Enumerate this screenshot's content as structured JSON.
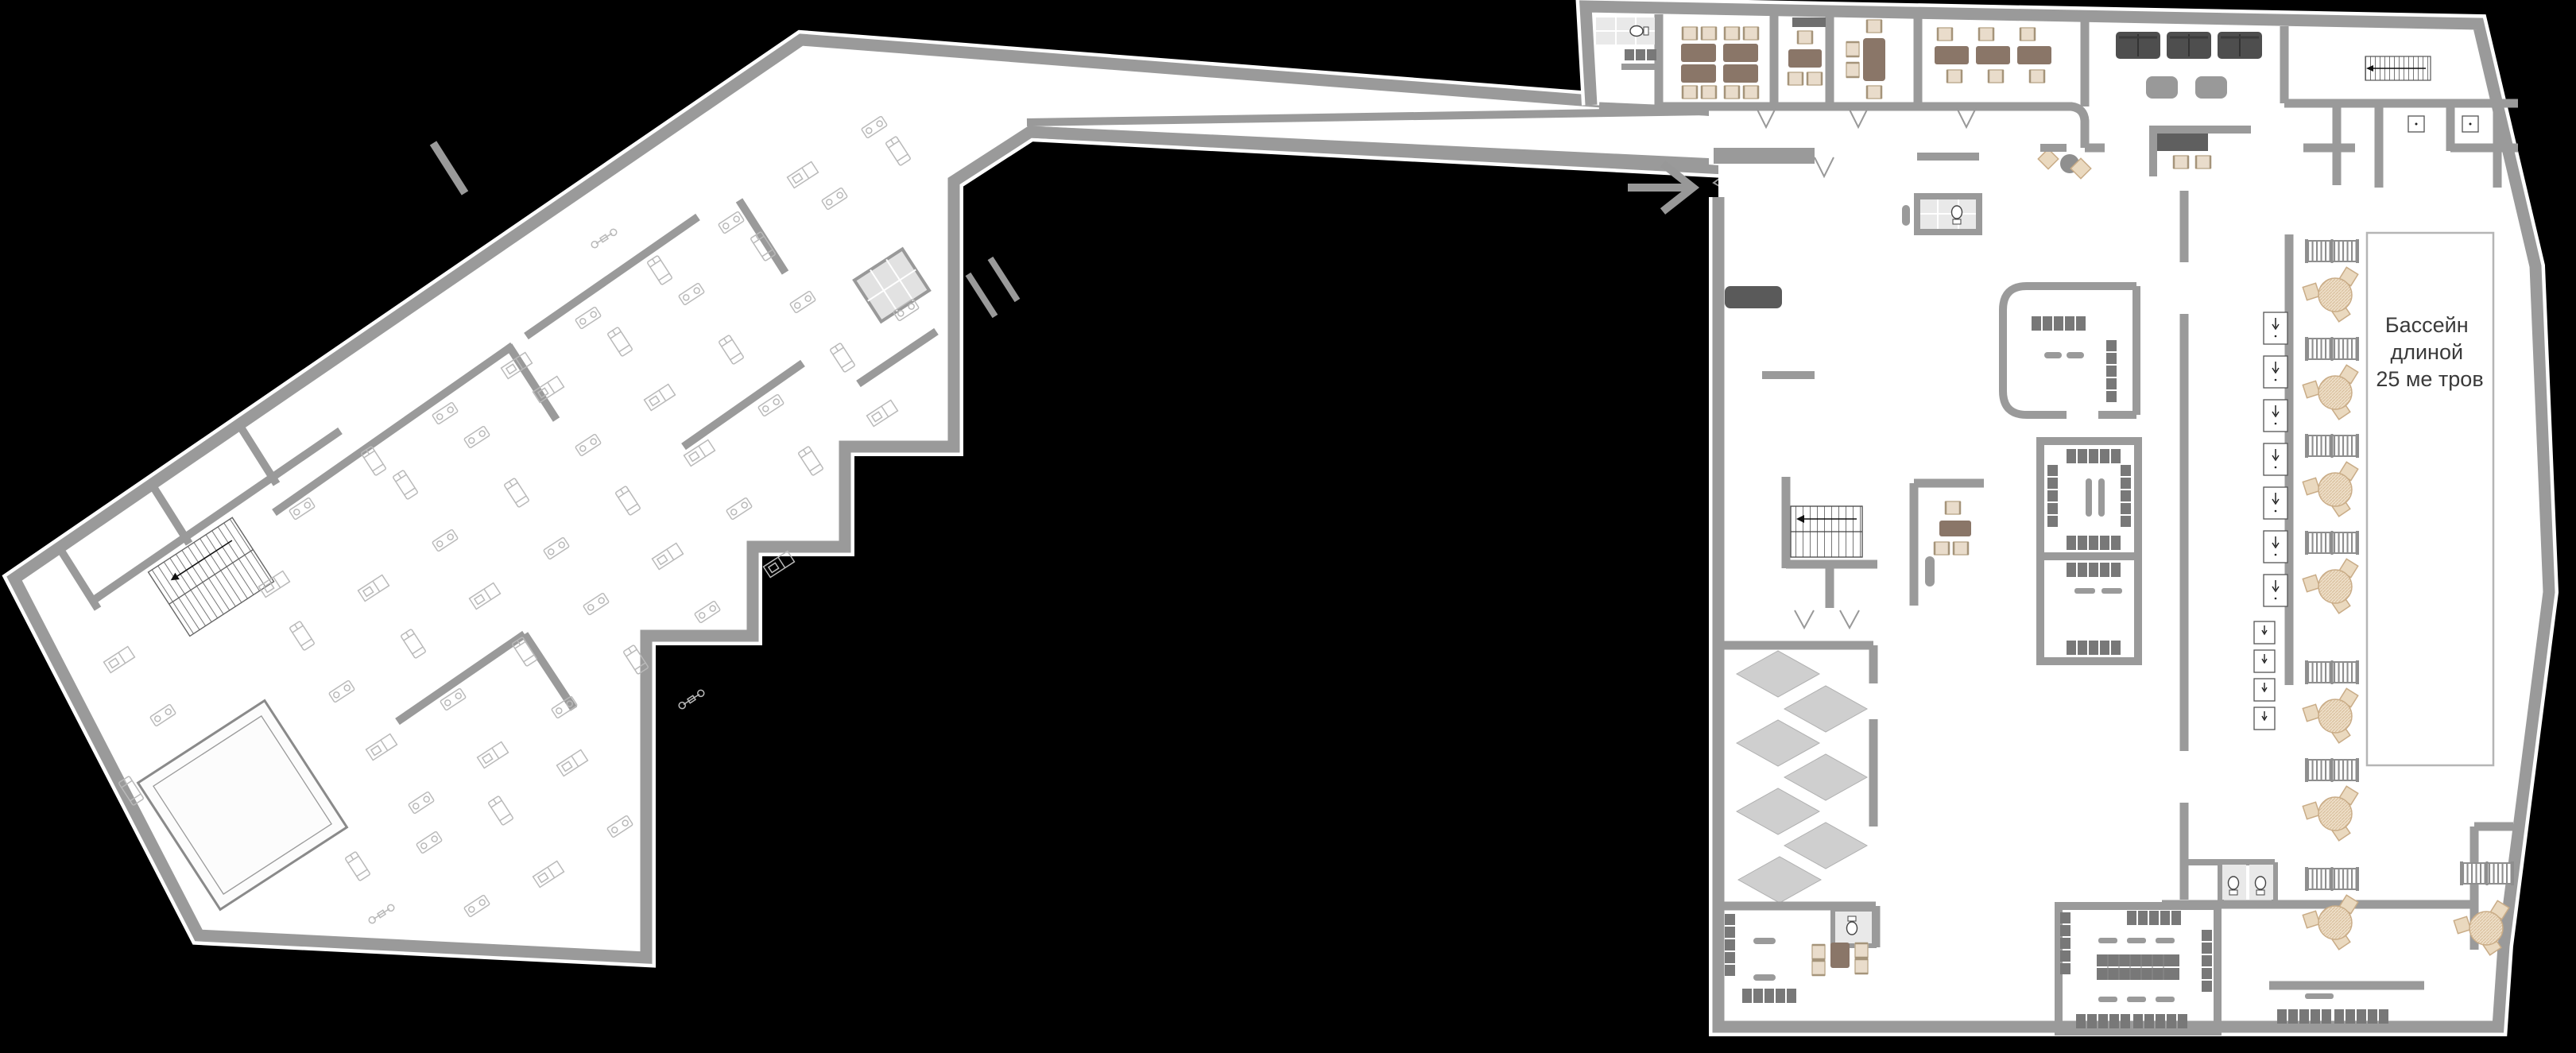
{
  "plan": {
    "pool": {
      "label_line1": "Бассейн",
      "label_line2": "длиной",
      "label_line3": "25 ме тров"
    },
    "entrance": {
      "arrow_icon": "right-arrow"
    }
  },
  "colors": {
    "background": "#000000",
    "wall": "#9a9a9a",
    "floor": "#ffffff",
    "table-brown": "#8a7668",
    "chair-beige": "#e9dccb",
    "sofa-dark": "#4e4e4e",
    "locker-gray": "#787878",
    "diamond-gray": "#cfcfcf",
    "tan": "#e3cdb0"
  }
}
